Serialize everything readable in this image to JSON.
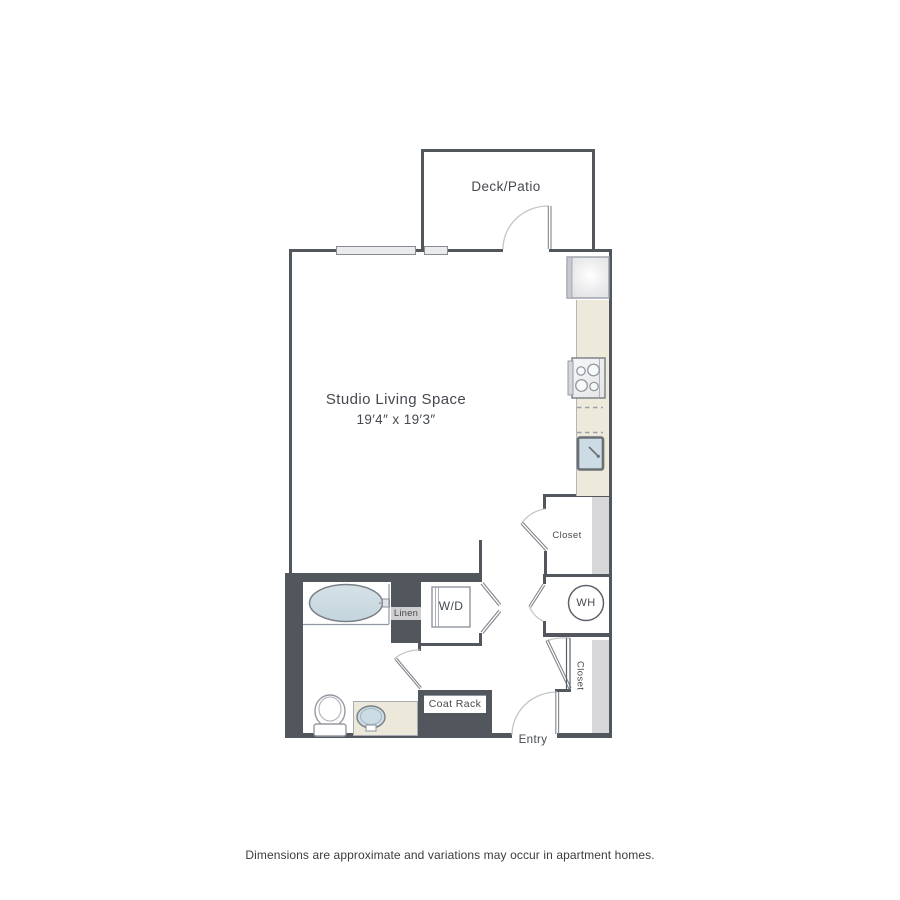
{
  "floorplan": {
    "labels": {
      "deck": "Deck/Patio",
      "living": "Studio Living Space",
      "living_dims": "19′4″ x 19′3″",
      "closet_mid": "Closet",
      "water_heater": "WH",
      "linen": "Linen",
      "washer_dryer": "W/D",
      "coat_rack": "Coat Rack",
      "closet_entry": "Closet",
      "entry": "Entry"
    },
    "colors": {
      "wall": "#52575e",
      "kitchen_counter": "#edeadb",
      "fixture_blue": "#cddce3",
      "closet_rod": "#d7d7d9",
      "linen_band": "#cfcfd1",
      "door_arc": "#c2c5c9",
      "label_text": "#45494f"
    }
  },
  "footer": {
    "disclaimer": "Dimensions are approximate and variations may occur in apartment homes."
  }
}
